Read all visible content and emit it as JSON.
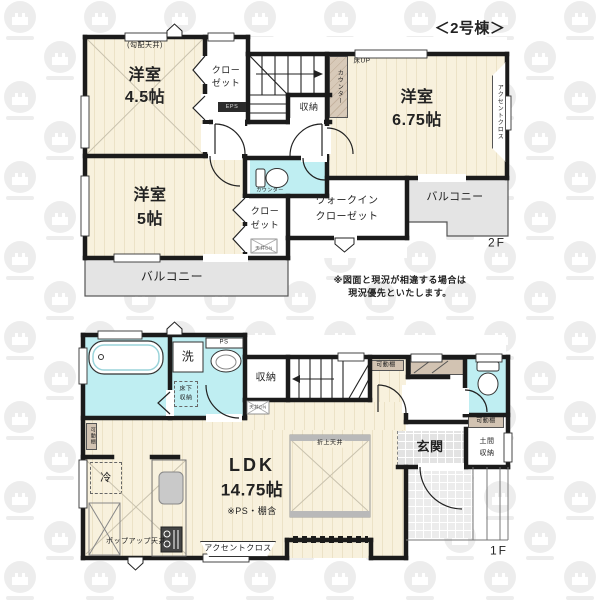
{
  "header": {
    "building_label": "＜2号棟＞"
  },
  "colors": {
    "floor_wood": "#f8f1dd",
    "floor_wet": "#bfeef2",
    "balcony": "#e4e4e4",
    "wall": "#1b1b1b",
    "counter_tan": "#d2c3b2"
  },
  "floor2": {
    "floor_label": "2F",
    "room45": {
      "line1": "洋室",
      "line2": "4.5帖",
      "ceiling_note": "(勾配天井)"
    },
    "room675": {
      "line1": "洋室",
      "line2": "6.75帖"
    },
    "room5": {
      "line1": "洋室",
      "line2": "5帖"
    },
    "closet_top": {
      "line1": "クロー",
      "line2": "ゼット"
    },
    "closet_bottom": {
      "line1": "クロー",
      "line2": "ゼット"
    },
    "wic": {
      "line1": "ウォークイン",
      "line2": "クローゼット"
    },
    "storage_label": "収納",
    "eps_label": "EPS",
    "counter_label": "カウンター",
    "floor_up_label": "床UP",
    "accent_cross_label": "アクセントクロス",
    "toilet_counter_label": "カウンター",
    "ceiling_hatch_label": "天井DN",
    "balcony_right_label": "バルコニー",
    "balcony_bottom_label": "バルコニー"
  },
  "floor1": {
    "floor_label": "1F",
    "ldk": {
      "line1": "LDK",
      "line2": "14.75帖",
      "note": "※PS・棚含"
    },
    "genkan_label": "玄関",
    "doma": {
      "line1": "土間",
      "line2": "収納"
    },
    "storage_label": "収納",
    "wash_label": "洗",
    "ps_label": "PS",
    "underfloor": {
      "line1": "床下",
      "line2": "収納"
    },
    "ceiling_hatch_label": "天井DN",
    "movable_shelf_label": "可動棚",
    "fridge_label": "冷",
    "popup_ceiling_label": "ポップアップ天井",
    "accent_cross_label": "アクセントクロス",
    "coffered_ceiling_label": "折上天井"
  },
  "footer": {
    "disclaimer_line1": "※図面と現況が相違する場合は",
    "disclaimer_line2": "現況優先といたします。"
  }
}
